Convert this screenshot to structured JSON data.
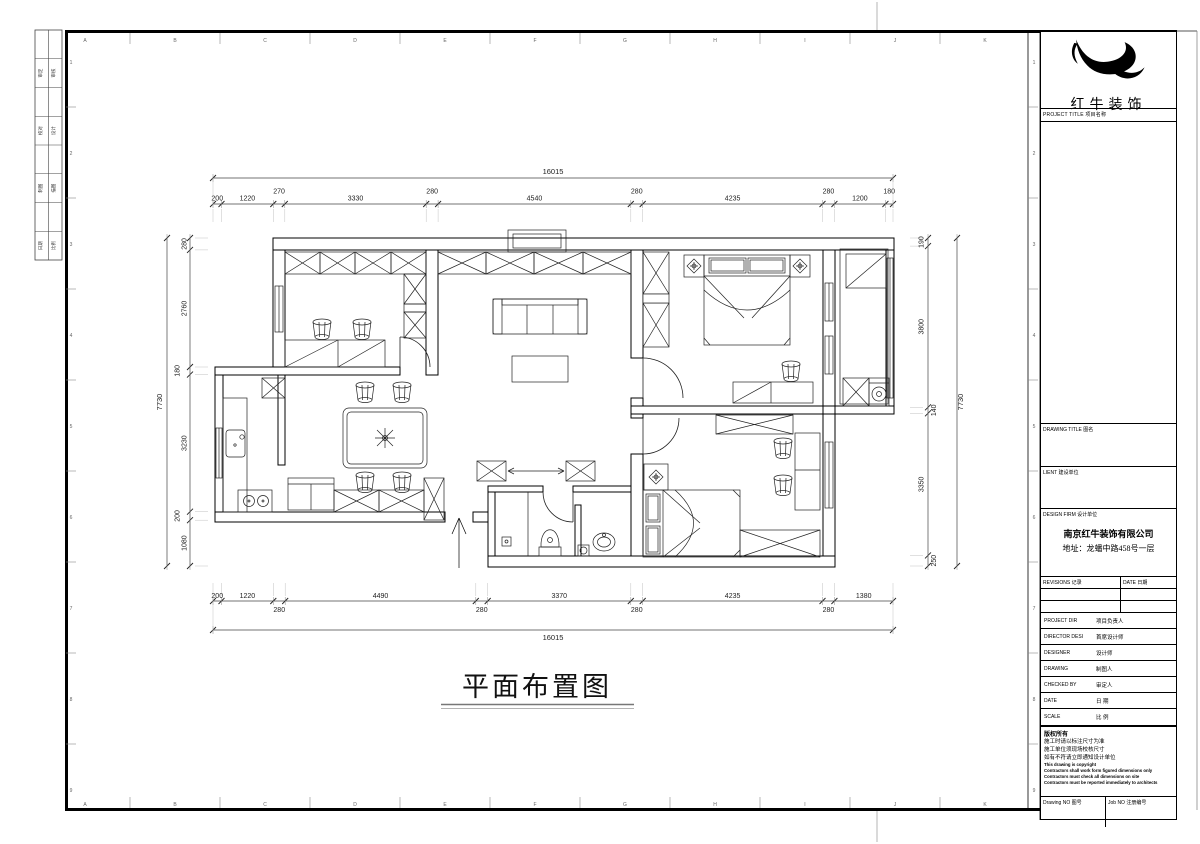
{
  "sheet": {
    "grid_letters": [
      "A",
      "B",
      "C",
      "D",
      "E",
      "F",
      "G",
      "H",
      "I",
      "J",
      "K"
    ],
    "row_numbers": [
      "1",
      "2",
      "3",
      "4",
      "5",
      "6",
      "7",
      "8",
      "9"
    ],
    "signoff_rows": [
      [
        "审定",
        "审核"
      ],
      [
        "校对",
        "设计"
      ],
      [
        "制图",
        "描图"
      ],
      [
        "日期",
        "比例"
      ]
    ]
  },
  "brand": {
    "company_name": "红牛装饰"
  },
  "title_block": {
    "project_title_label": "PROJECT TITLE  项目名称",
    "drawing_title_label": "DRAWING TITLE  图名",
    "client_label": "LIENT  建设单位",
    "design_firm_label": "DESIGN FIRM  设计单位",
    "design_firm_name": "南京红牛装饰有限公司",
    "design_firm_address": "地址：龙蟠中路458号一层",
    "revisions_label": "REVISIONS  记录",
    "revisions_date_label": "DATE  日期",
    "rows": [
      {
        "en": "PROJECT DIR",
        "cn": "项目负责人"
      },
      {
        "en": "DIRECTOR DESI",
        "cn": "首席设计师"
      },
      {
        "en": "DESIGNER",
        "cn": "设计师"
      },
      {
        "en": "DRAWING",
        "cn": "制图人"
      },
      {
        "en": "CHECKED BY",
        "cn": "审定人"
      },
      {
        "en": "DATE",
        "cn": "日  期"
      },
      {
        "en": "SCALE",
        "cn": "比  例"
      }
    ],
    "copyright": {
      "title": "版权所有",
      "lines_cn": [
        "施工时请以标注尺寸为准",
        "施工单位须现场校核尺寸",
        "如有不符请立即通知设计单位"
      ],
      "lines_en": [
        "This drawing is copyright",
        "Contractors shall work form figured dimensions only",
        "Contractors must check all dimensions on site",
        "Contractors must be reported immediately to architects"
      ]
    },
    "drawing_no_label": "Drawing NO  图号",
    "job_no_label": "Job NO  注册编号"
  },
  "drawing": {
    "title": "平面布置图",
    "dimensions": {
      "top_total": "16015",
      "top_chain": [
        "200",
        "1220",
        "270",
        "3330",
        "280",
        "4540",
        "280",
        "4235",
        "280",
        "1200",
        "180"
      ],
      "bottom_total": "16015",
      "bottom_chain": [
        "200",
        "1220",
        "280",
        "4490",
        "280",
        "3370",
        "280",
        "4235",
        "280",
        "1380"
      ],
      "left_total": "7730",
      "left_chain": [
        "280",
        "2760",
        "180",
        "3230",
        "200",
        "1080"
      ],
      "right_total": "7730",
      "right_chain": [
        "190",
        "3800",
        "140",
        "3350",
        "250"
      ]
    }
  }
}
